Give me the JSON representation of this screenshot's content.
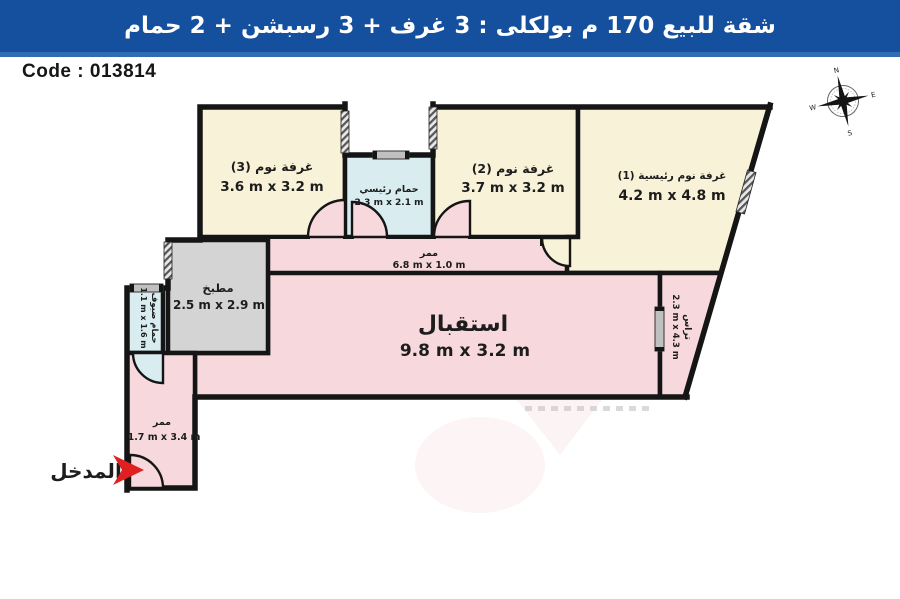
{
  "title_bar": {
    "text": "شقة للبيع 170 م بولكلى :  3 غرف + 3 رسبشن + 2 حمام",
    "bg_color": "#14509e",
    "accent_color": "#2e6cb4"
  },
  "code_label": "Code : 013814",
  "compass": {
    "n": "N",
    "e": "E",
    "s": "S",
    "w": "W"
  },
  "colors": {
    "wall": "#151515",
    "bedroom_fill": "#f8f2d8",
    "living_fill": "#f6d8dd",
    "bath_fill": "#d9edf0",
    "kitchen_fill": "#d4d4d4",
    "entrance_arrow": "#e02020"
  },
  "rooms": {
    "bedroom3": {
      "name": "غرفة نوم (3)",
      "dims": "3.6 m x 3.2 m"
    },
    "master_bath": {
      "name": "حمام رئيسي",
      "dims": "2.3 m x 2.1 m"
    },
    "bedroom2": {
      "name": "غرفة نوم (2)",
      "dims": "3.7 m x 3.2 m"
    },
    "master_bedroom": {
      "name": "غرفة نوم رئيسية (1)",
      "dims": "4.2 m x 4.8 m"
    },
    "corridor": {
      "name": "ممر",
      "dims": "6.8 m x 1.0 m"
    },
    "kitchen": {
      "name": "مطبخ",
      "dims": "2.5 m x 2.9 m"
    },
    "guest_bath": {
      "name": "حمام ضيوف",
      "dims": "1.1 m x 1.6 m"
    },
    "reception": {
      "name": "استقبال",
      "dims": "9.8 m x 3.2 m"
    },
    "terrace": {
      "name": "تراس",
      "dims": "2.3 m x 4.3 m"
    },
    "entry_corridor": {
      "name": "ممر",
      "dims": "1.7 m x 3.4 m"
    },
    "entrance": {
      "name": "المدخل"
    }
  },
  "watermark": {
    "line1": "MAX",
    "line2": "AVALON"
  }
}
